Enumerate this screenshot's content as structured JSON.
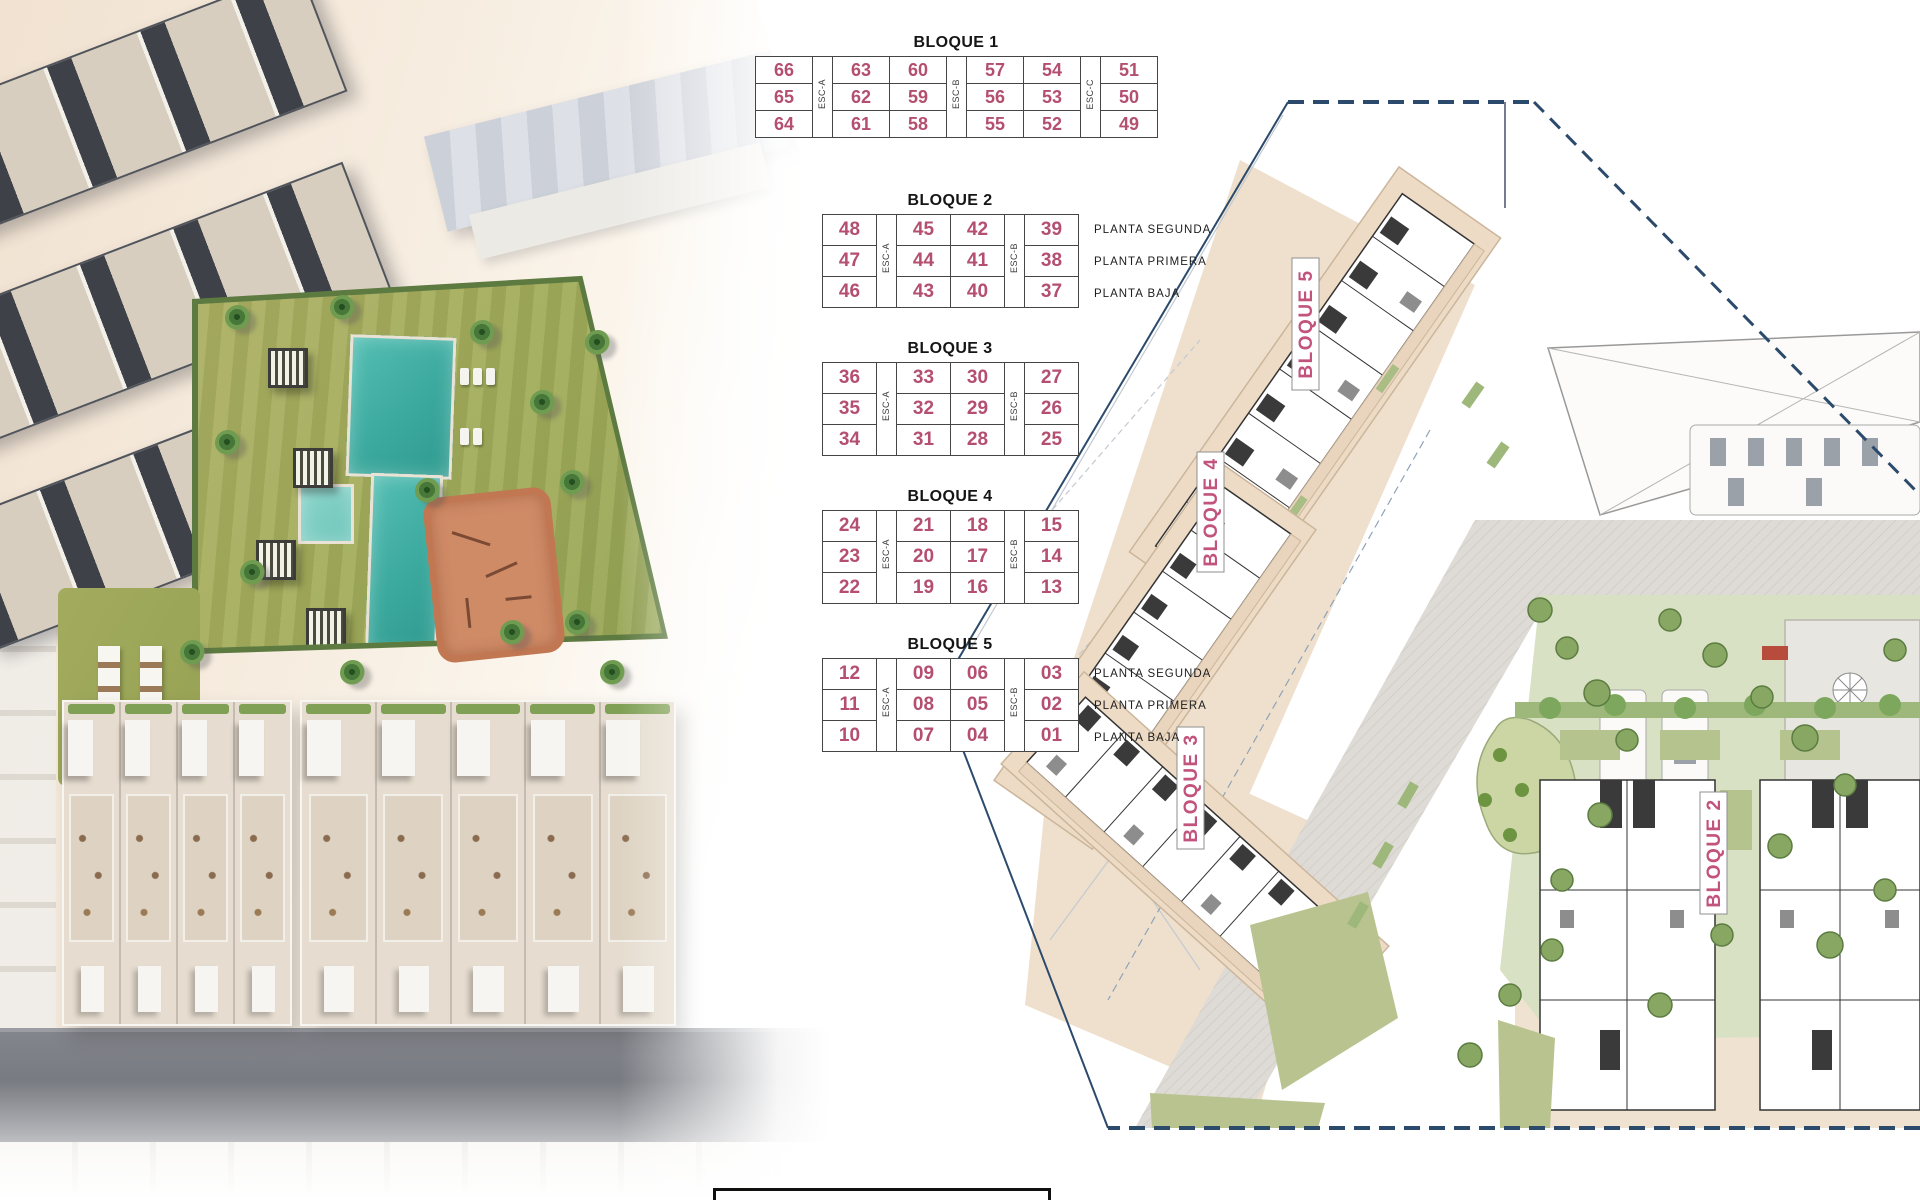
{
  "tables": {
    "planta_labels": [
      "PLANTA SEGUNDA",
      "PLANTA PRIMERA",
      "PLANTA BAJA"
    ],
    "blocks": [
      {
        "title": "BLOQUE 1",
        "columns": [
          {
            "type": "units",
            "values": [
              "66",
              "65",
              "64"
            ]
          },
          {
            "type": "esc",
            "label": "ESC-A"
          },
          {
            "type": "units",
            "values": [
              "63",
              "62",
              "61"
            ]
          },
          {
            "type": "units",
            "values": [
              "60",
              "59",
              "58"
            ]
          },
          {
            "type": "esc",
            "label": "ESC-B"
          },
          {
            "type": "units",
            "values": [
              "57",
              "56",
              "55"
            ]
          },
          {
            "type": "units",
            "values": [
              "54",
              "53",
              "52"
            ]
          },
          {
            "type": "esc",
            "label": "ESC-C"
          },
          {
            "type": "units",
            "values": [
              "51",
              "50",
              "49"
            ]
          }
        ],
        "show_planta": false
      },
      {
        "title": "BLOQUE 2",
        "columns": [
          {
            "type": "units",
            "values": [
              "48",
              "47",
              "46"
            ]
          },
          {
            "type": "esc",
            "label": "ESC-A"
          },
          {
            "type": "units",
            "values": [
              "45",
              "44",
              "43"
            ]
          },
          {
            "type": "units",
            "values": [
              "42",
              "41",
              "40"
            ]
          },
          {
            "type": "esc",
            "label": "ESC-B"
          },
          {
            "type": "units",
            "values": [
              "39",
              "38",
              "37"
            ]
          }
        ],
        "show_planta": true
      },
      {
        "title": "BLOQUE 3",
        "columns": [
          {
            "type": "units",
            "values": [
              "36",
              "35",
              "34"
            ]
          },
          {
            "type": "esc",
            "label": "ESC-A"
          },
          {
            "type": "units",
            "values": [
              "33",
              "32",
              "31"
            ]
          },
          {
            "type": "units",
            "values": [
              "30",
              "29",
              "28"
            ]
          },
          {
            "type": "esc",
            "label": "ESC-B"
          },
          {
            "type": "units",
            "values": [
              "27",
              "26",
              "25"
            ]
          }
        ],
        "show_planta": false
      },
      {
        "title": "BLOQUE 4",
        "columns": [
          {
            "type": "units",
            "values": [
              "24",
              "23",
              "22"
            ]
          },
          {
            "type": "esc",
            "label": "ESC-A"
          },
          {
            "type": "units",
            "values": [
              "21",
              "20",
              "19"
            ]
          },
          {
            "type": "units",
            "values": [
              "18",
              "17",
              "16"
            ]
          },
          {
            "type": "esc",
            "label": "ESC-B"
          },
          {
            "type": "units",
            "values": [
              "15",
              "14",
              "13"
            ]
          }
        ],
        "show_planta": false
      },
      {
        "title": "BLOQUE 5",
        "columns": [
          {
            "type": "units",
            "values": [
              "12",
              "11",
              "10"
            ]
          },
          {
            "type": "esc",
            "label": "ESC-A"
          },
          {
            "type": "units",
            "values": [
              "09",
              "08",
              "07"
            ]
          },
          {
            "type": "units",
            "values": [
              "06",
              "05",
              "04"
            ]
          },
          {
            "type": "esc",
            "label": "ESC-B"
          },
          {
            "type": "units",
            "values": [
              "03",
              "02",
              "01"
            ]
          }
        ],
        "show_planta": true
      }
    ]
  },
  "plan": {
    "labels": [
      {
        "text": "BLOQUE 5"
      },
      {
        "text": "BLOQUE 4"
      },
      {
        "text": "BLOQUE 3"
      },
      {
        "text": "BLOQUE 2"
      }
    ],
    "colors": {
      "boundary": "#2c4a6b",
      "label_text": "#c2537c",
      "building_fill": "#eedbc5",
      "green": "#d8e1c4",
      "lawn": "#b9c390"
    }
  },
  "render": {
    "colors": {
      "pool": "#47b4a9",
      "lawn": "#9faa58",
      "playground": "#cf8a66",
      "road": "#6b6d74"
    }
  }
}
